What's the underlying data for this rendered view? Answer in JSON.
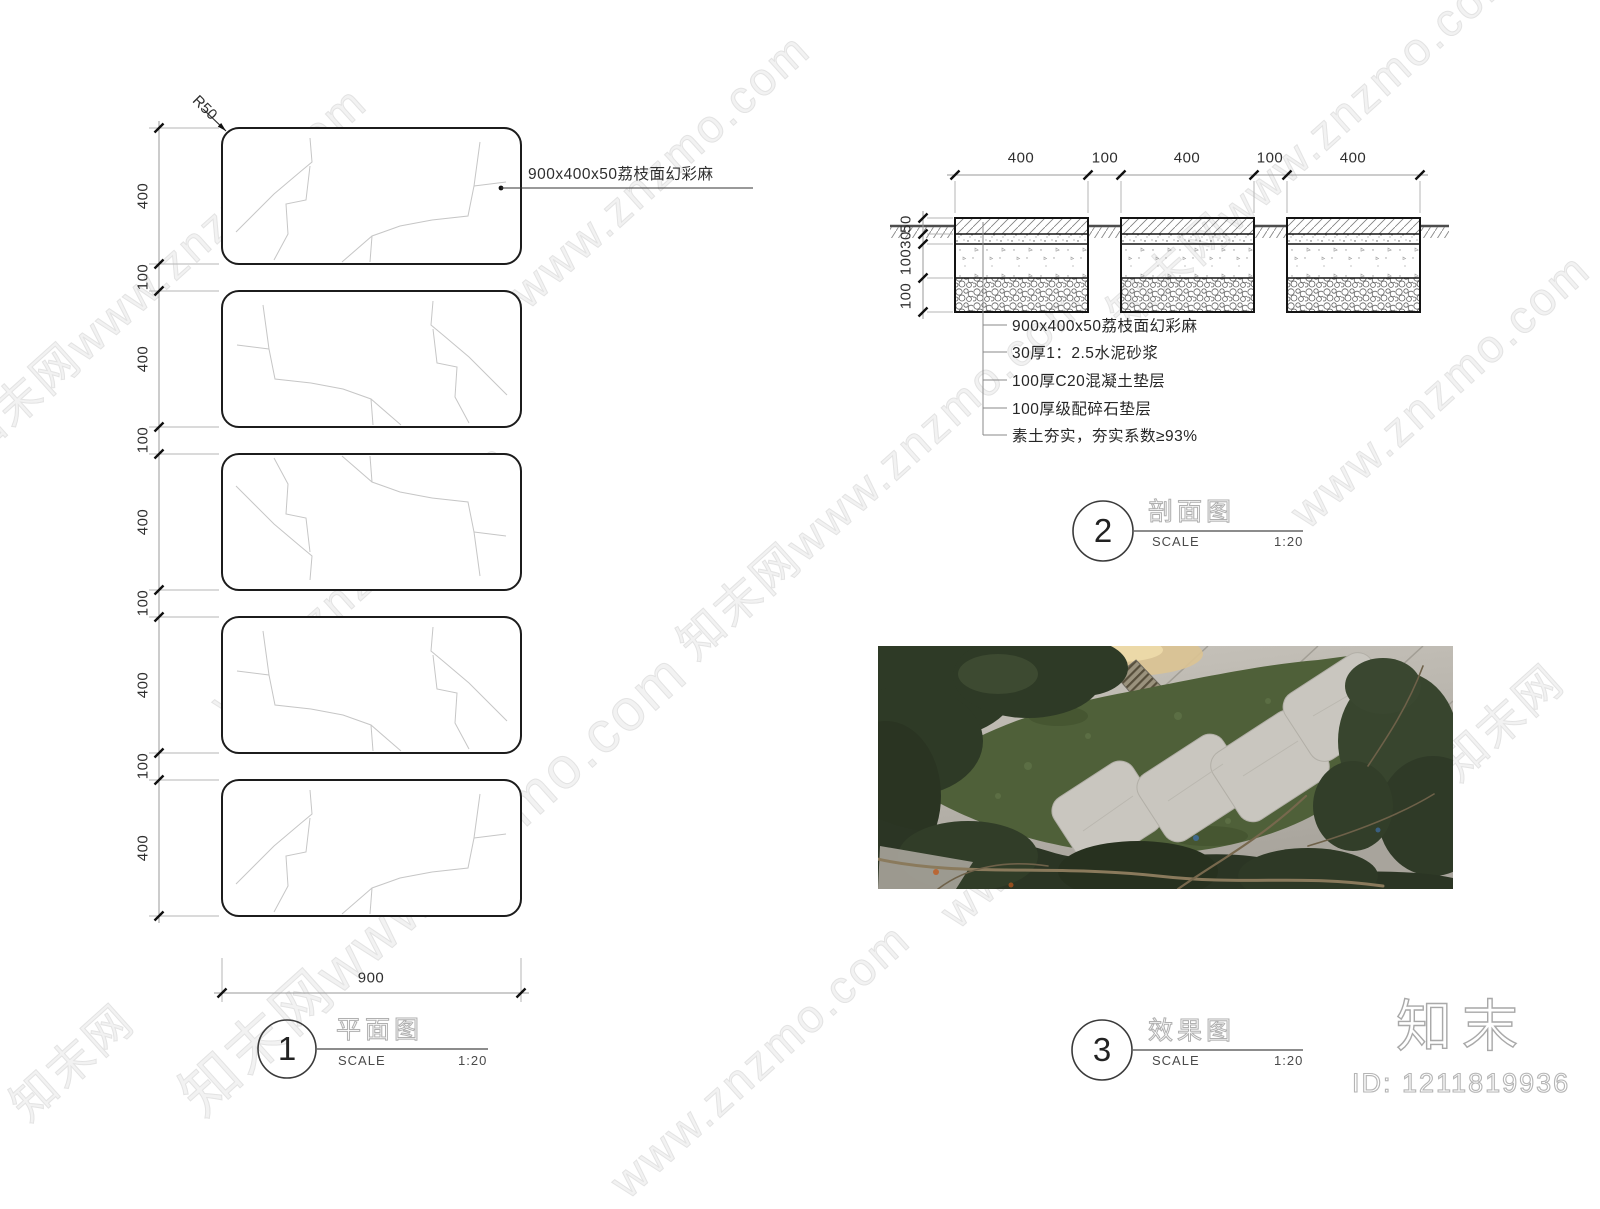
{
  "watermark": {
    "brand": "知末网",
    "url": "www.znzmo.com",
    "combined": "知末网www.znzmo.com"
  },
  "footer": {
    "logo": "知末",
    "id_label": "ID: 1211819936"
  },
  "plan": {
    "figure_number": "1",
    "title": "平面图",
    "scale_label": "SCALE",
    "scale_value": "1:20",
    "radius_label": "R50",
    "material_label": "900x400x50荔枝面幻彩麻",
    "bottom_dim": "900",
    "left_dims": [
      "400",
      "100",
      "400",
      "100",
      "400",
      "100",
      "400",
      "100",
      "400"
    ]
  },
  "section": {
    "figure_number": "2",
    "title": "剖面图",
    "scale_label": "SCALE",
    "scale_value": "1:20",
    "top_dims": [
      "400",
      "100",
      "400",
      "100",
      "400"
    ],
    "side_dims": [
      "50",
      "30",
      "100",
      "100"
    ],
    "notes": [
      "900x400x50荔枝面幻彩麻",
      "30厚1：2.5水泥砂浆",
      "100厚C20混凝土垫层",
      "100厚级配碎石垫层",
      "素土夯实，夯实系数≥93%"
    ]
  },
  "photo_panel": {
    "figure_number": "3",
    "title": "效果图",
    "scale_label": "SCALE",
    "scale_value": "1:20"
  }
}
